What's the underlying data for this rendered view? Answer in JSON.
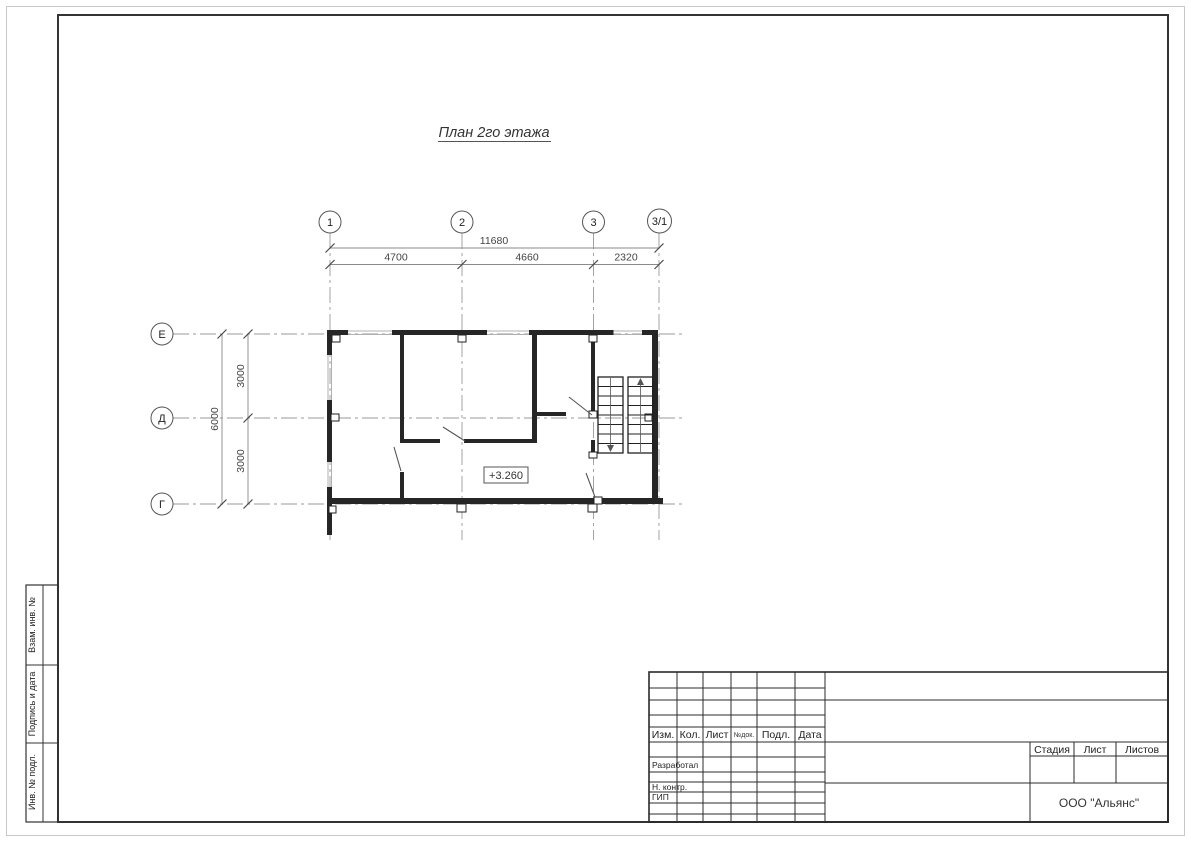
{
  "drawing": {
    "title": "План 2го этажа",
    "elevation": "+3.260",
    "axes_top": [
      "1",
      "2",
      "3",
      "3/1"
    ],
    "axes_left": [
      "Е",
      "Д",
      "Г"
    ],
    "dims": {
      "total_h": "11680",
      "spans_h": [
        "4700",
        "4660",
        "2320"
      ],
      "total_v": "6000",
      "spans_v": [
        "3000",
        "3000"
      ]
    }
  },
  "stamp_column": [
    "Взам. инв. №",
    "Подпись и дата",
    "Инв. № подл."
  ],
  "title_block": {
    "header": [
      "Изм.",
      "Кол.",
      "Лист",
      "№док.",
      "Подл.",
      "Дата"
    ],
    "roles": [
      "Разработал",
      "Н. контр.",
      "ГИП"
    ],
    "stage": [
      "Стадия",
      "Лист",
      "Листов"
    ],
    "company": "ООО \"Альянс\""
  }
}
